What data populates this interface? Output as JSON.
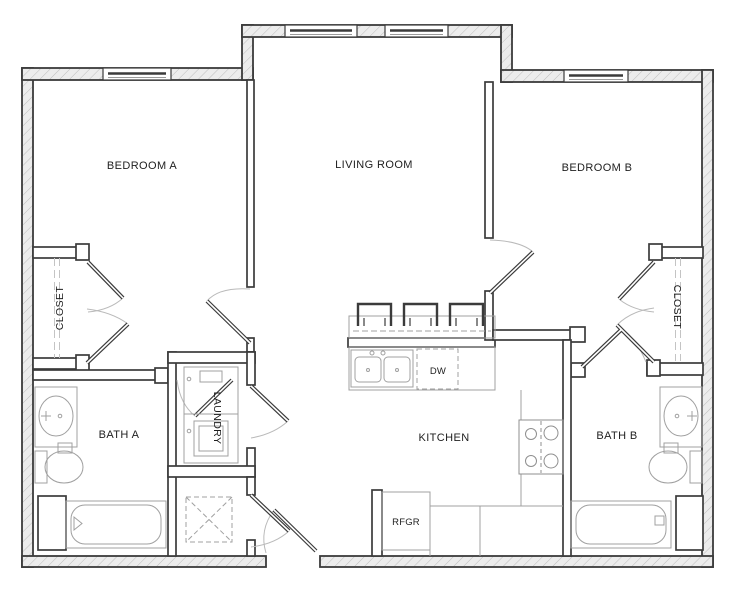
{
  "title": "Two Bedroom Apartment Floor Plan",
  "rooms": {
    "bedroom_a": "BEDROOM A",
    "living_room": "LIVING ROOM",
    "bedroom_b": "BEDROOM B",
    "closet_a": "CLOSET",
    "closet_b": "CLOSET",
    "bath_a": "BATH A",
    "bath_b": "BATH B",
    "laundry": "LAUNDRY",
    "kitchen": "KITCHEN"
  },
  "appliances": {
    "dishwasher": "DW",
    "refrigerator": "RFGR"
  },
  "colors": {
    "wall_line": "#3b3b3b",
    "exterior_fill": "#ececec",
    "hatch_line": "#bdbdbd",
    "fixture_line": "#a0a0a0",
    "door_arc": "#bababa",
    "text": "#1e1e1e",
    "background": "#ffffff"
  }
}
